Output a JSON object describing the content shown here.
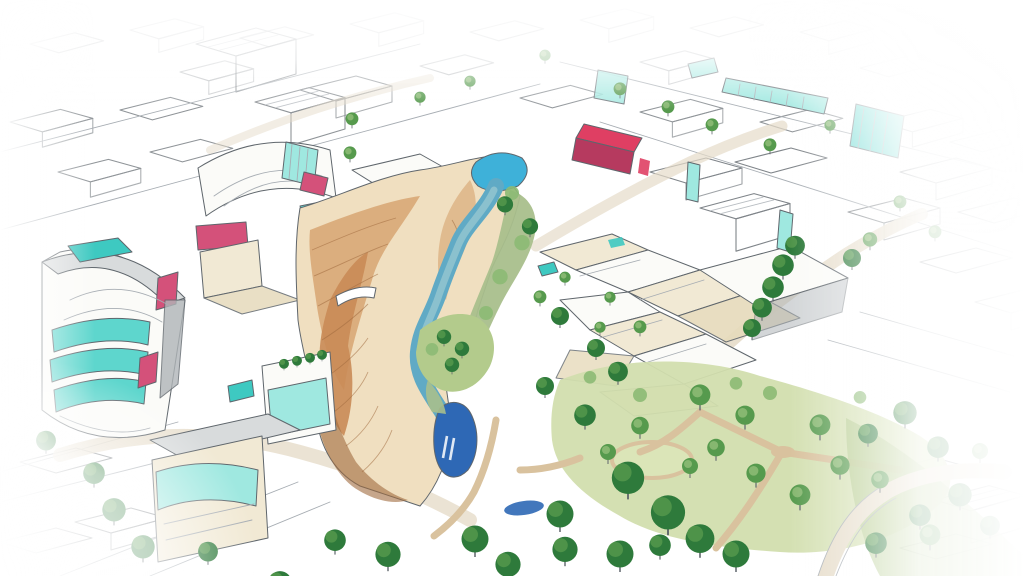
{
  "scene": {
    "title": "Hand-drawn aerial concept sketch: urban district with canyon river and park",
    "style": "watercolor-and-ink architectural rendering",
    "elements": {
      "canyon": "terraced tan canyon walls",
      "river": "winding blue river with upper pool and lower pond",
      "waterfall": "small waterfall",
      "bridge": "white arched footbridge",
      "left_tower": "curved tower with teal glass bands and pink accents",
      "mall": "curved-roof building with teal glass atrium",
      "galleria": "long teal glass strip building",
      "crimson_building": "crimson accent building",
      "village": "cluster of cream low-rise buildings",
      "park": "tree-filled park with lawns and tan paths",
      "rooftop_pools": "teal rooftop pools",
      "streets": "sketched street grid fading to white at edges"
    }
  },
  "palette": {
    "paper": "#ffffff",
    "sketch_line": "#5f666c",
    "sketch_line_light": "#a7adb3",
    "roof_gray": "#d8dbdc",
    "wall_gray": "#b0b5b8",
    "white_face": "#fbfbf8",
    "cream": "#f1e9d4",
    "cream_dark": "#e6dabb",
    "teal_glass": "#5ed6cd",
    "teal_glass_light": "#9fe8e0",
    "teal_pool": "#3ec9c1",
    "pink_accent": "#d4517a",
    "pink_accent_dark": "#b63a5f",
    "crimson_accent": "#df3f63",
    "pool_blue": "#3eb1d9",
    "river_light": "#93c6cf",
    "river_mid": "#60aac5",
    "river_dark": "#2e68b5",
    "canyon_cream": "#f0dfc0",
    "canyon_tan": "#d9ab7a",
    "canyon_orange": "#c98b57",
    "canyon_brown": "#a06a3e",
    "bank_sage": "#a9bf8c",
    "lawn_light": "#d2deae",
    "lawn_mid": "#b3cb8c",
    "tree_dark": "#2e7a3b",
    "tree_mid": "#569a4d",
    "tree_light": "#8cba74",
    "path_tan": "#d9c29e",
    "road_beige": "#e6dcc9"
  }
}
